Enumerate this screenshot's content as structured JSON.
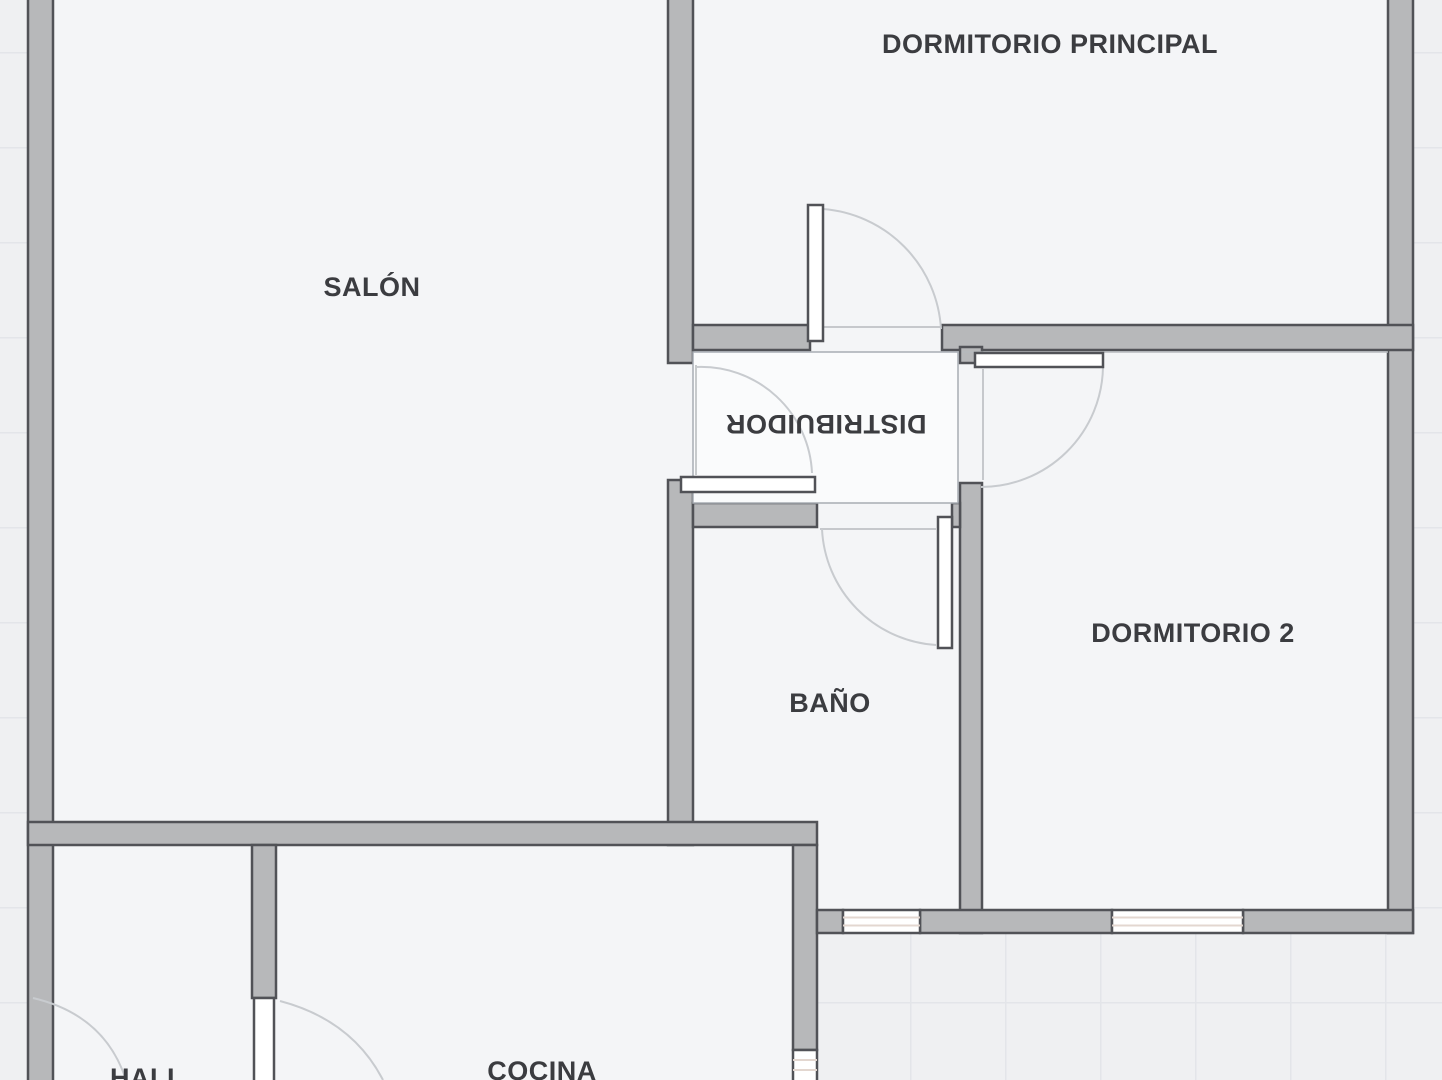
{
  "floorplan": {
    "type": "apartment-floor-plan",
    "rooms": [
      {
        "id": "salon",
        "label": "SALÓN"
      },
      {
        "id": "dormitorio-principal",
        "label": "DORMITORIO PRINCIPAL"
      },
      {
        "id": "distribuidor",
        "label": "DISTRIBUIDOR"
      },
      {
        "id": "dormitorio-2",
        "label": "DORMITORIO 2"
      },
      {
        "id": "bano",
        "label": "BAÑO"
      },
      {
        "id": "hall",
        "label": "HALL"
      },
      {
        "id": "cocina",
        "label": "COCINA"
      }
    ],
    "colors": {
      "exterior_bg": "#eff0f2",
      "grid_line": "#e3e5e9",
      "room_fill": "#f4f5f7",
      "wall_fill": "#b7b8ba",
      "wall_stroke": "#515257",
      "leaf_fill": "#ffffff",
      "arc_stroke": "#c8cbcf",
      "opening_line": "#b6b9bd",
      "window_stripe": "#e3d7d0",
      "distrib_fill": "#fafbfc",
      "distrib_stroke": "#a8adb3",
      "label_color": "#3b3c40"
    }
  }
}
